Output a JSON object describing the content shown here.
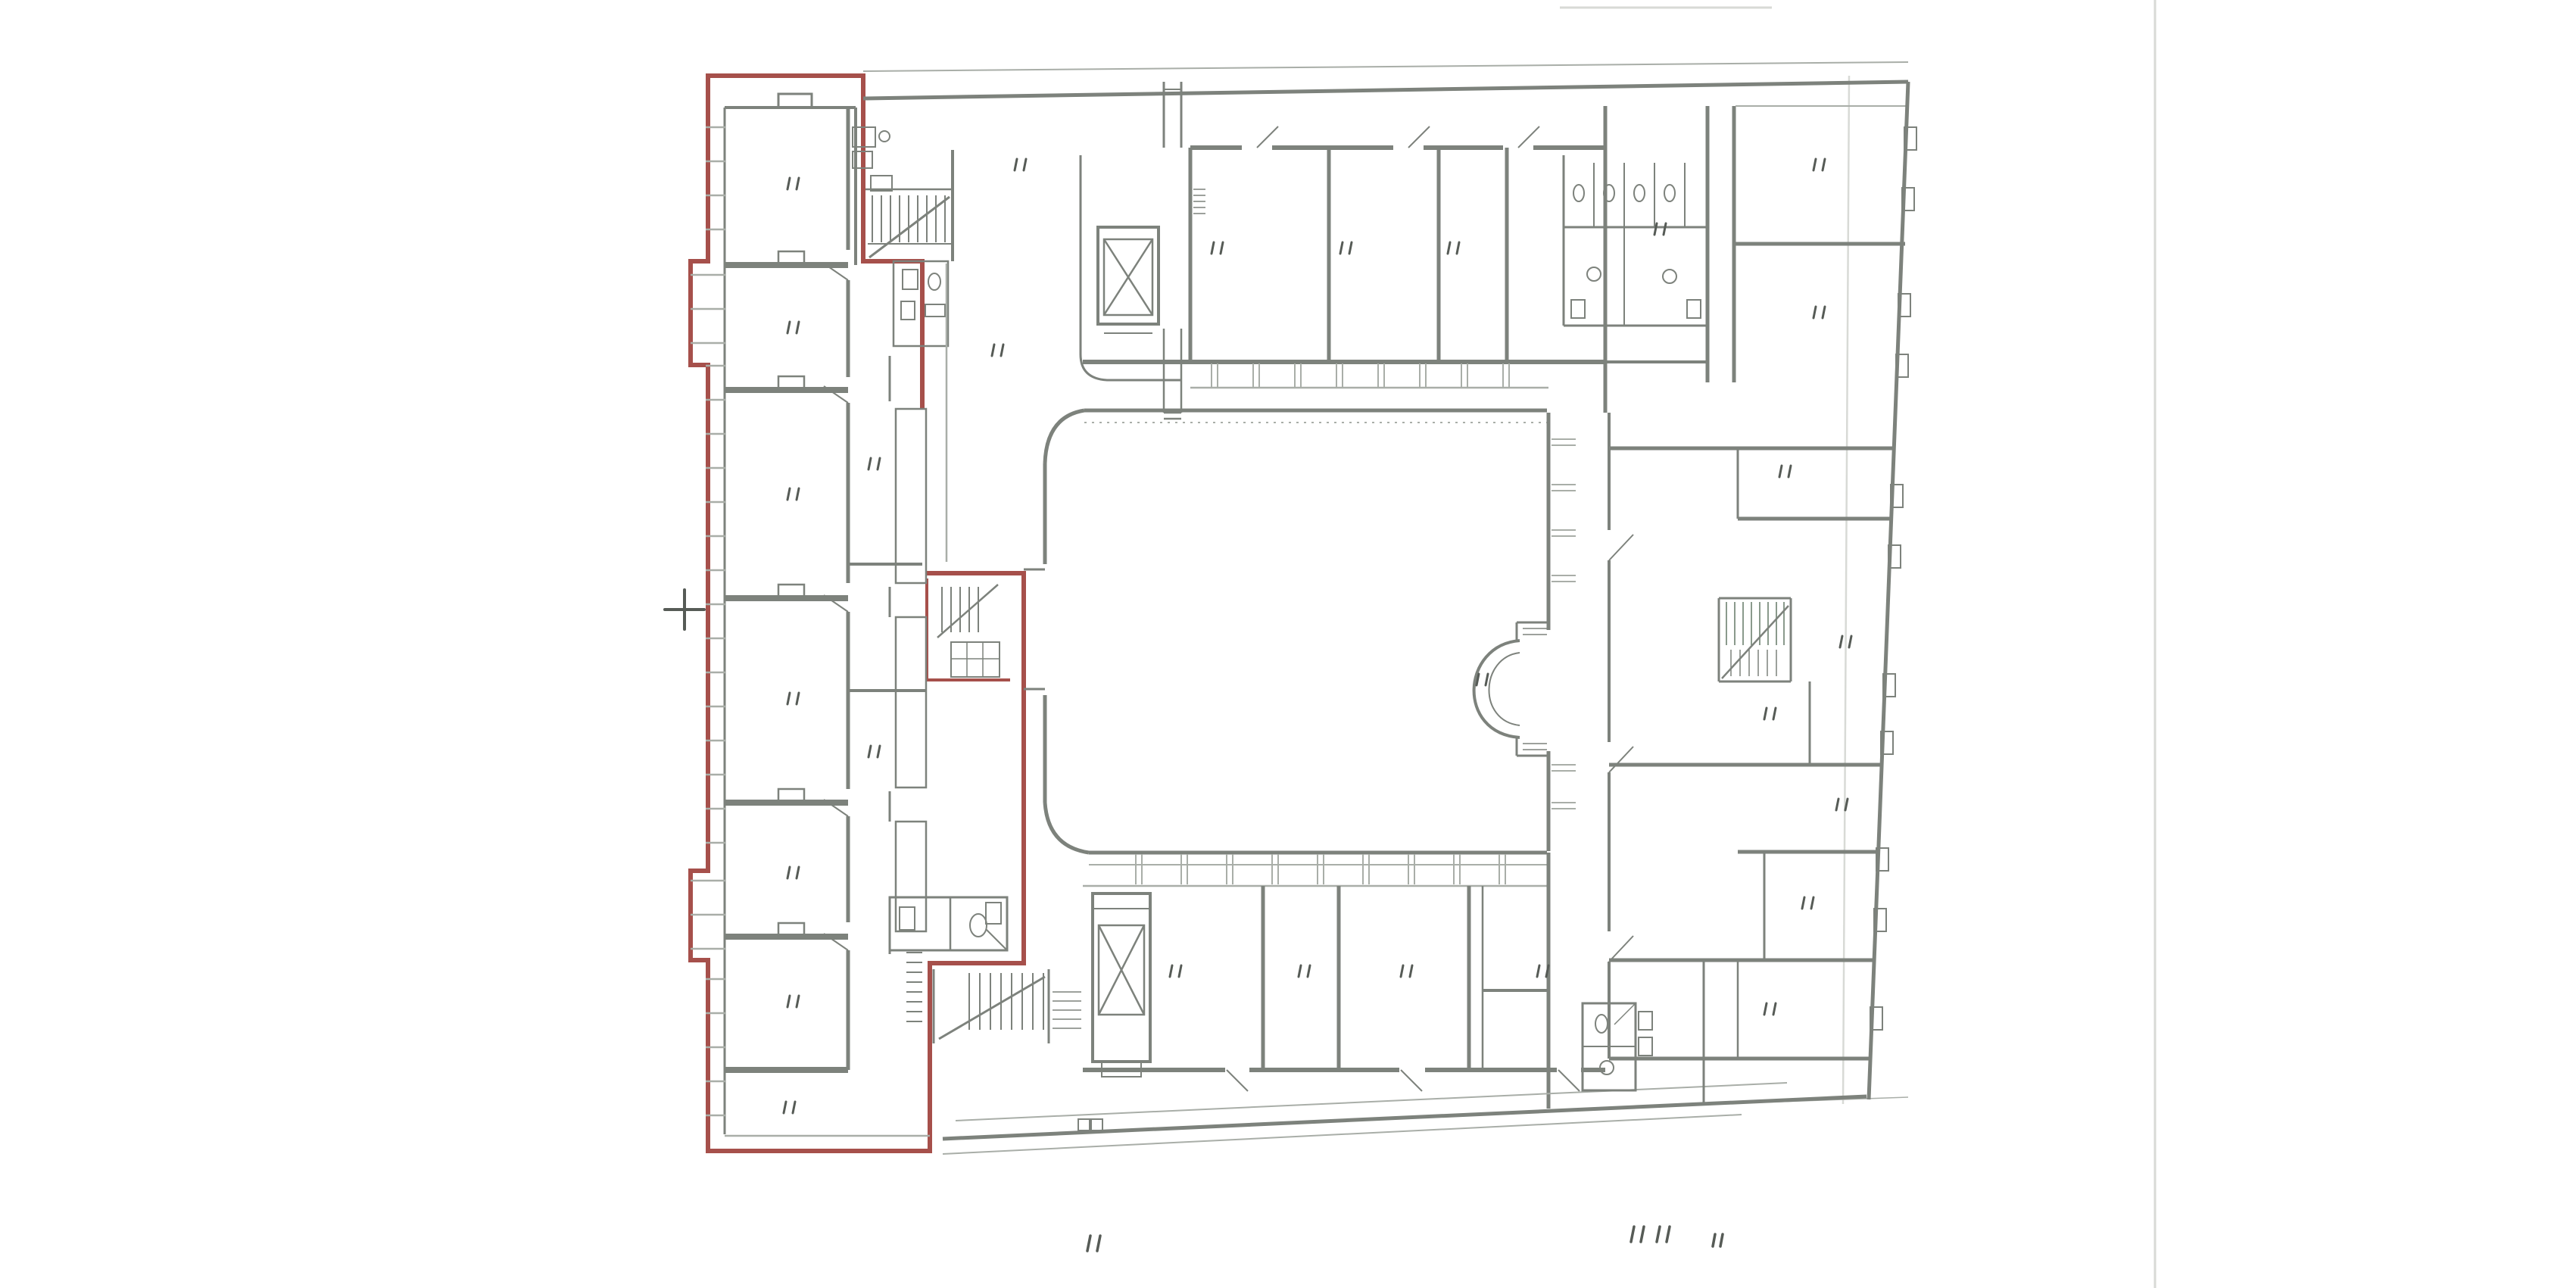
{
  "document": {
    "kind": "scanned architectural floor plan with highlighted unit outline",
    "page_background": "#ffffff"
  },
  "colors": {
    "bg": "#ffffff",
    "wall": "#7d827c",
    "wall_light": "#a9aea8",
    "outline_red": "#a6504b",
    "label_mark": "#565b56",
    "stair_accent": "#8a9a8c",
    "artifact": "#d8dad6"
  },
  "plan": {
    "highlight": {
      "name": "red-unit-outline",
      "color_ref": "outline_red"
    },
    "features": [
      {
        "name": "left-wing"
      },
      {
        "name": "top-wing"
      },
      {
        "name": "right-wing"
      },
      {
        "name": "bottom-wing"
      },
      {
        "name": "courtyard"
      },
      {
        "name": "apse-bay"
      },
      {
        "name": "elevator-top-icon"
      },
      {
        "name": "elevator-bottom-icon"
      },
      {
        "name": "stair-top-left-icon"
      },
      {
        "name": "stair-box-icon"
      },
      {
        "name": "stair-bottom-left-icon"
      },
      {
        "name": "stair-right-icon"
      },
      {
        "name": "wc-cluster-top-right-icon"
      },
      {
        "name": "wc-cluster-bottom-icon"
      },
      {
        "name": "window-ticks"
      },
      {
        "name": "datum-cross-icon"
      },
      {
        "name": "room-label-marks"
      },
      {
        "name": "annotation-marks"
      },
      {
        "name": "scan-artifacts"
      }
    ]
  }
}
